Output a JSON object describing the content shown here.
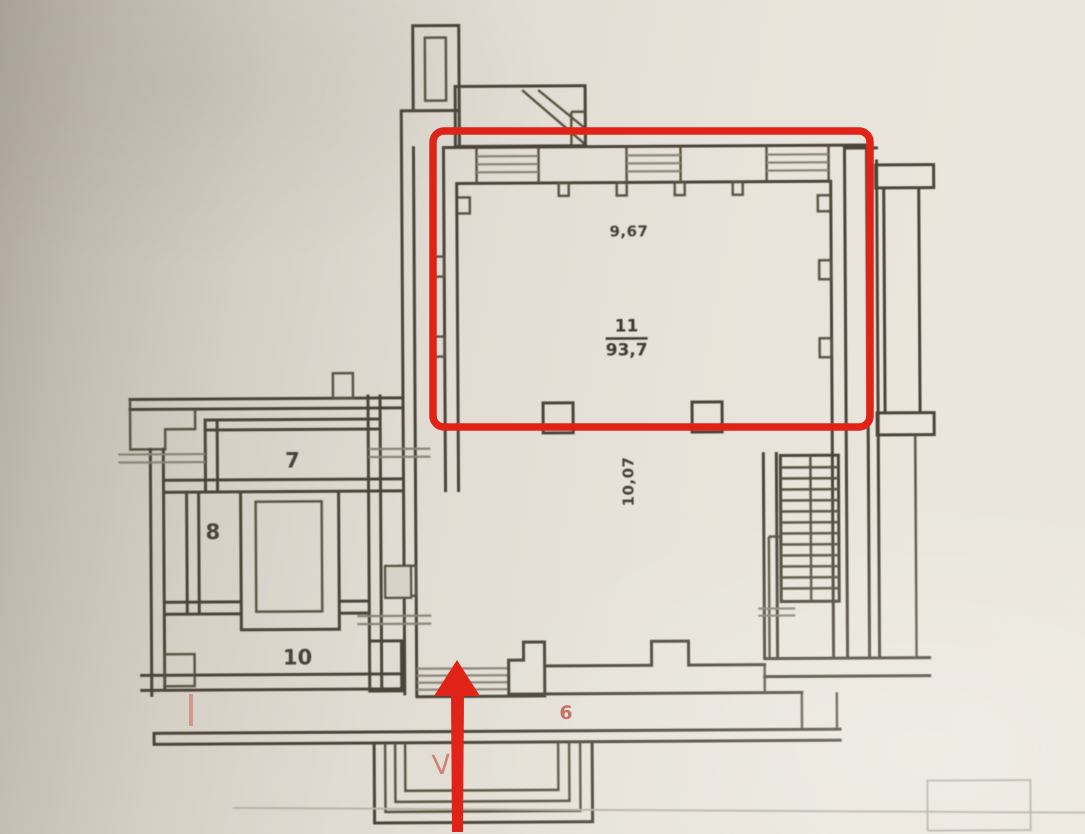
{
  "palette": {
    "paper": "#e7e3da",
    "wall_line": "#4b4439",
    "annotation_red": "#e02217",
    "faded_red": "#bf5047"
  },
  "rooms": {
    "room7": {
      "number": "7"
    },
    "room8": {
      "number": "8"
    },
    "room9": {
      "number": "9"
    },
    "room10": {
      "number": "10"
    },
    "room11": {
      "number": "11",
      "area": "93,7",
      "width_dimension": "9,67",
      "depth_dimension": "10,07"
    }
  },
  "red_marks": {
    "section_number": "6",
    "entrance_mark": "V"
  }
}
